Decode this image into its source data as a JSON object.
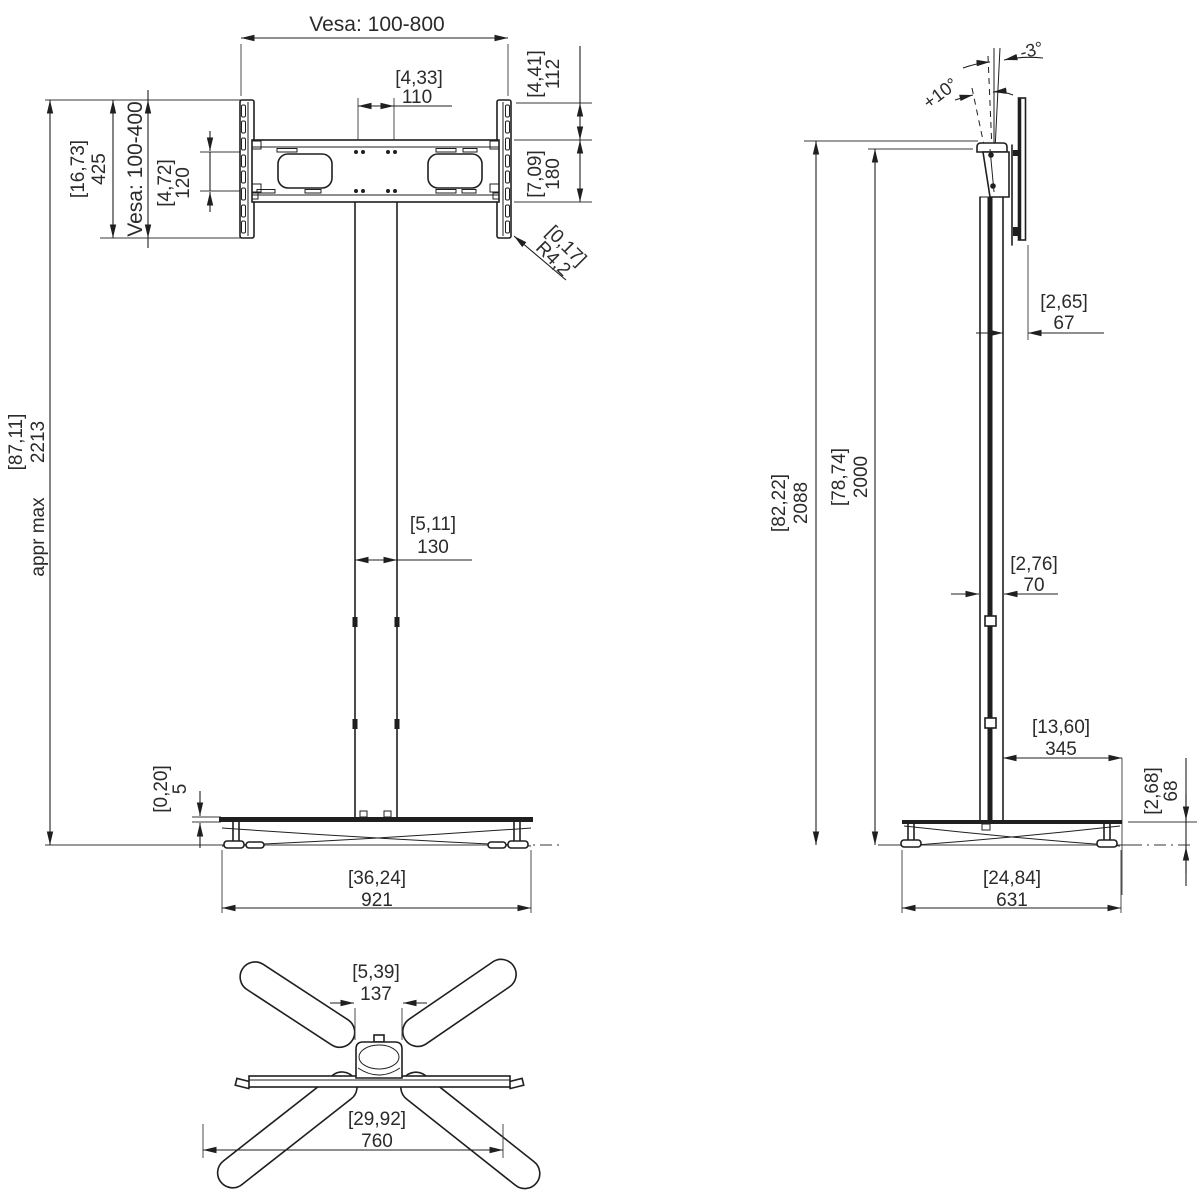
{
  "colors": {
    "line": "#1f1f1f",
    "ground": "#787878",
    "text": "#2b2b2b",
    "background": "#ffffff"
  },
  "front_view": {
    "vesa_width": "Vesa: 100-800",
    "vesa_height": "Vesa: 100-400",
    "hole_spacing": {
      "in": "[4,33]",
      "mm": "110"
    },
    "top_section": {
      "in": "[4,41]",
      "mm": "112"
    },
    "bracket_height": {
      "in": "[16,73]",
      "mm": "425"
    },
    "hole_rows": {
      "in": "[4,72]",
      "mm": "120"
    },
    "lower_section": {
      "in": "[7,09]",
      "mm": "180"
    },
    "corner_radius": {
      "in": "[0,17]",
      "mm": "R4,2"
    },
    "max_height": {
      "in": "[87,11]",
      "mm": "2213",
      "note": "appr max"
    },
    "column_width": {
      "in": "[5,11]",
      "mm": "130"
    },
    "plate_thickness": {
      "in": "[0,20]",
      "mm": "5"
    },
    "base_width": {
      "in": "[36,24]",
      "mm": "921"
    }
  },
  "side_view": {
    "tilt_back": "-3°",
    "tilt_forward": "+10°",
    "mount_depth": {
      "in": "[2,65]",
      "mm": "67"
    },
    "total_height": {
      "in": "[82,22]",
      "mm": "2088"
    },
    "column_height": {
      "in": "[78,74]",
      "mm": "2000"
    },
    "column_depth": {
      "in": "[2,76]",
      "mm": "70"
    },
    "base_rear_reach": {
      "in": "[13,60]",
      "mm": "345"
    },
    "base_height": {
      "in": "[2,68]",
      "mm": "68"
    },
    "base_depth": {
      "in": "[24,84]",
      "mm": "631"
    }
  },
  "bottom_view": {
    "hub_width": {
      "in": "[5,39]",
      "mm": "137"
    },
    "foot_spread": {
      "in": "[29,92]",
      "mm": "760"
    }
  }
}
